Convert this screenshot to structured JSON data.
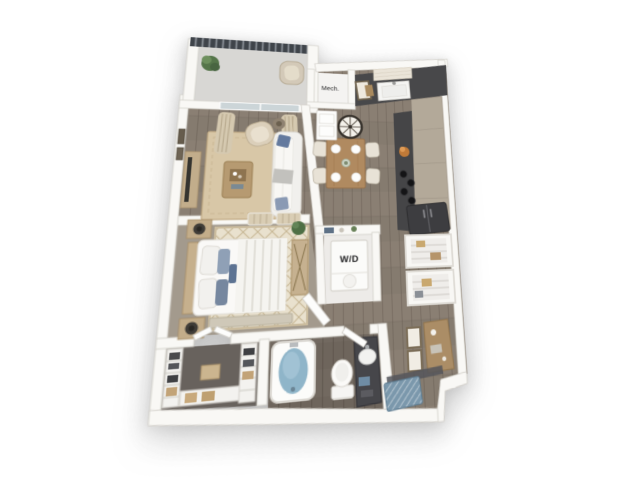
{
  "window": {
    "width": 640,
    "height": 480,
    "background": "#ffffff"
  },
  "artwork": {
    "kind": "3d-floor-plan-rendering",
    "view": "top-down-perspective",
    "unit_type": "one-bedroom-apartment"
  },
  "floorplan": {
    "labels": {
      "mech_closet": "Mech.",
      "washer_dryer": "W/D"
    },
    "rooms": [
      "balcony",
      "living-room",
      "dining-area",
      "kitchen",
      "entry-hall",
      "mechanical-closet",
      "laundry-closet",
      "bedroom",
      "walk-in-closet",
      "bathroom",
      "pantry-shelving",
      "desk-nook"
    ],
    "furniture": [
      "balcony-plant",
      "balcony-chair",
      "sliding-glass-door",
      "curtains",
      "tv-console",
      "sofa",
      "armchair",
      "side-table",
      "coffee-table",
      "living-rug",
      "wall-clock",
      "dining-table",
      "dining-chairs",
      "kitchen-sink",
      "window-shade",
      "cooktop-burners",
      "refrigerator",
      "stacked-washer-dryer",
      "bed",
      "nightstands",
      "lamps",
      "dresser",
      "bedroom-rug",
      "foot-bench",
      "bathtub",
      "toilet",
      "vanity-sink",
      "wire-shelving",
      "desk",
      "art-frames",
      "entry-mat"
    ],
    "colors": {
      "wall": "#f9f8f5",
      "wall_edge": "#d3d0ca",
      "wood_floor": "#857b6f",
      "bath_floor": "#6e655c",
      "closet_floor": "#68625d",
      "bedroom_carpet": "#a39a8d",
      "balcony_floor": "#d8d7d4",
      "living_rug": "#d8c7a7",
      "bedroom_rug": "#e9e1ce",
      "counter_dark": "#48484a",
      "cabinet_greige": "#b3a999",
      "table_wood": "#b08a60",
      "water_blue": "#8fb5c9",
      "entry_mat_blue": "#7b98ac",
      "pillow_blue": "#647a9e",
      "railing_dark": "#3f444a",
      "plant_green": "#55754a",
      "appliance_dark": "#3d3d40"
    }
  }
}
